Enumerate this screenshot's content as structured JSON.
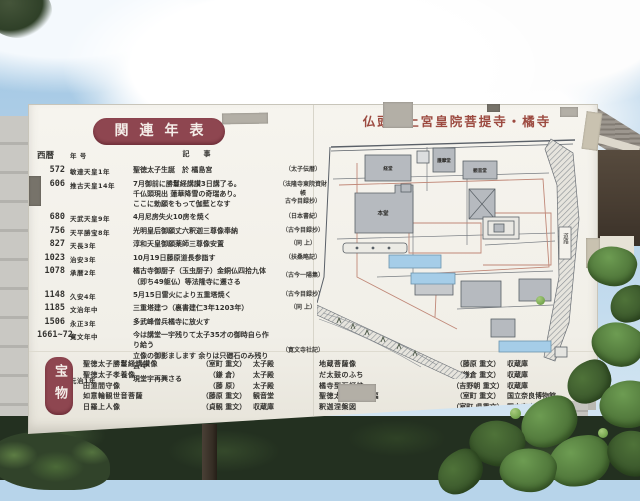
{
  "sign": {
    "map": {
      "title": "仏頭山上宮皇院菩提寺・橘寺",
      "road_label": "道路",
      "buildings": [
        {
          "label": "経堂"
        },
        {
          "label": "護摩堂"
        },
        {
          "label": "観音堂"
        },
        {
          "label": "本堂"
        }
      ]
    },
    "chronology": {
      "title": "関連年表",
      "columns": {
        "year": "西暦",
        "era": "年 号",
        "event": "記事"
      },
      "rows": [
        {
          "year": "572",
          "era": "敏達天皇1年",
          "event": "聖徳太子生誕　於 橘島宮",
          "source": "太子伝暦"
        },
        {
          "year": "606",
          "era": "推古天皇14年",
          "event": [
            "7月御前に勝鬘経講讃3日講了る。",
            "千仏頭現出 蓮華降雪の奇瑞あり。",
            "ここに勅願をもって伽藍となす"
          ],
          "source": [
            "法隆寺東院資財帳",
            "古今目録抄"
          ]
        },
        {
          "year": "680",
          "era": "天武天皇9年",
          "event": "4月尼房失火10房を焼く",
          "source": "日本書紀"
        },
        {
          "year": "756",
          "era": "天平勝宝8年",
          "event": "光明皇后御願丈六釈迦三尊像奉納",
          "source": "古今目録抄"
        },
        {
          "year": "827",
          "era": "天長3年",
          "event": "淳和天皇御願薬師三尊像安置",
          "source": "同 上"
        },
        {
          "year": "1023",
          "era": "治安3年",
          "event": "10月19日藤原道長参詣す",
          "source": "扶桑略記"
        },
        {
          "year": "1078",
          "era": "承暦2年",
          "event": [
            "橘古寺御厨子（玉虫厨子）金銅仏四拾九体",
            "（即ち49躯仏）等法隆寺に遷さる"
          ],
          "source": "古今一陽集"
        },
        {
          "year": "1148",
          "era": "久安4年",
          "event": "5月15日雷火により五重塔焼く",
          "source": "古今目録抄"
        },
        {
          "year": "1185",
          "era": "文治年中",
          "event": "三重塔建つ（裏書建仁3年1203年）",
          "source": "同 上"
        },
        {
          "year": "1506",
          "era": "永正3年",
          "event": "多武峰僧兵橘寺に放火す",
          "source": ""
        },
        {
          "year": "1661~72",
          "era": "寛文年中",
          "event": [
            "今は講堂一宇残りて太子35才の御時自ら作り給う",
            "立像の御影まします 余りは只礎石のみ残り云々"
          ],
          "source": "寛文寺社記"
        },
        {
          "year": "1864",
          "era": "元治1年",
          "event": "現堂宇再興さる",
          "source": ""
        }
      ]
    },
    "treasures": {
      "label": "宝物",
      "left": [
        {
          "name": "聖徳太子勝鬘経講讃像",
          "era": "室町 重文",
          "place": "太子殿"
        },
        {
          "name": "聖徳太子孝養像",
          "era": "鎌 倉",
          "place": "太子殿"
        },
        {
          "name": "田道間守像",
          "era": "藤 原",
          "place": "太子殿"
        },
        {
          "name": "如意輪観世音菩薩",
          "era": "藤原 重文",
          "place": "観音堂"
        },
        {
          "name": "日羅上人像",
          "era": "貞観 重文",
          "place": "収蔵庫"
        }
      ],
      "right": [
        {
          "name": "地蔵菩薩像",
          "era": "藤原 重文",
          "place": "収蔵庫"
        },
        {
          "name": "だ太鼓のふち",
          "era": "鎌倉 重文",
          "place": "収蔵庫"
        },
        {
          "name": "橘寺型石灯炉",
          "era": "吉野朝 重文",
          "place": "収蔵庫"
        },
        {
          "name": "聖徳太子絵伝八幅",
          "era": "室町 重文",
          "place": "国立奈良博物館"
        },
        {
          "name": "釈迦涅槃図",
          "era": "室町 県重文",
          "place": "国立奈良博物館"
        }
      ]
    },
    "colors": {
      "plate_red": "#8e4650",
      "map_title_red": "#9c4a40",
      "board_white": "#f1efe8"
    }
  }
}
